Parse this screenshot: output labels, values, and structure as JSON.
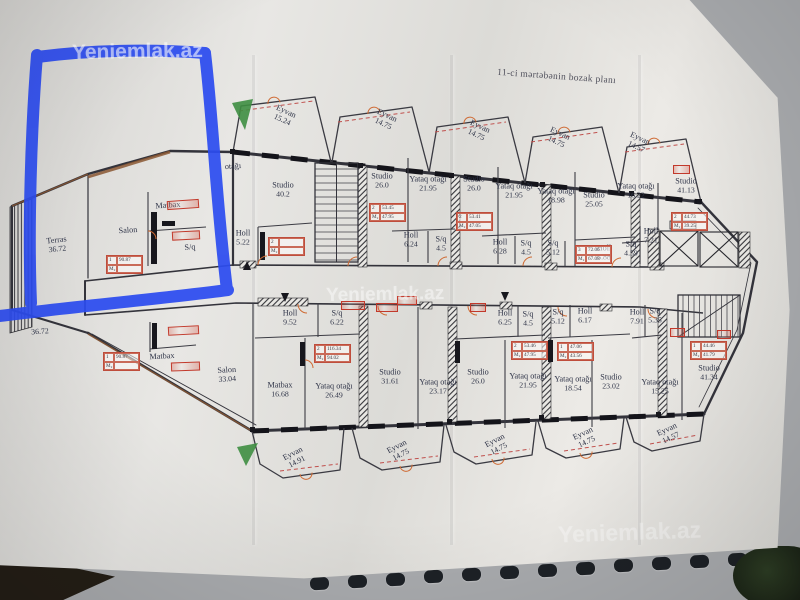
{
  "photo": {
    "title": "11-ci mərtəbənin bozak planı",
    "watermark_text": "Yeniemlak.az"
  },
  "annotation": {
    "marker_color": "#2c4cf0"
  },
  "watermarks": [
    {
      "x": 72,
      "y": 40,
      "size": 21,
      "rot": -1,
      "opacity": 0.6
    },
    {
      "x": 326,
      "y": 284,
      "size": 19,
      "rot": -1,
      "opacity": 0.48
    },
    {
      "x": 558,
      "y": 519,
      "size": 23,
      "rot": -2,
      "opacity": 0.4
    }
  ],
  "plan": {
    "rooms": [
      {
        "name": "Terras",
        "area": "36.72",
        "x": 57,
        "y": 245,
        "rot": -6
      },
      {
        "name": "Salon",
        "area": "",
        "x": 128,
        "y": 231,
        "rot": -4
      },
      {
        "name": "Matbax",
        "area": "",
        "x": 168,
        "y": 206,
        "rot": -4
      },
      {
        "name": "S/q",
        "area": "",
        "x": 190,
        "y": 248,
        "rot": -4
      },
      {
        "name": "otağı",
        "area": "",
        "x": 233,
        "y": 167,
        "rot": -4
      },
      {
        "name": "Holl",
        "area": "5.22",
        "x": 243,
        "y": 238,
        "rot": 0
      },
      {
        "name": "Eyvan",
        "area": "15.24",
        "x": 284,
        "y": 116,
        "rot": 25
      },
      {
        "name": "Studio",
        "area": "40.2",
        "x": 283,
        "y": 190,
        "rot": 0
      },
      {
        "name": "Eyvan",
        "area": "14.75",
        "x": 385,
        "y": 120,
        "rot": 25
      },
      {
        "name": "Studio",
        "area": "26.0",
        "x": 382,
        "y": 181,
        "rot": 0
      },
      {
        "name": "Yataq otağı",
        "area": "21.95",
        "x": 428,
        "y": 184,
        "rot": 0
      },
      {
        "name": "Holl",
        "area": "6.24",
        "x": 411,
        "y": 240,
        "rot": 0
      },
      {
        "name": "S/q",
        "area": "4.5",
        "x": 441,
        "y": 244,
        "rot": 0
      },
      {
        "name": "Eyvan",
        "area": "14.75",
        "x": 478,
        "y": 131,
        "rot": 25
      },
      {
        "name": "Studio",
        "area": "26.0",
        "x": 474,
        "y": 184,
        "rot": 0
      },
      {
        "name": "Yataq otağı",
        "area": "21.95",
        "x": 514,
        "y": 191,
        "rot": 0
      },
      {
        "name": "Holl",
        "area": "6.28",
        "x": 500,
        "y": 247,
        "rot": 0
      },
      {
        "name": "S/q",
        "area": "4.5",
        "x": 526,
        "y": 248,
        "rot": 0
      },
      {
        "name": "Eyvan",
        "area": "14.75",
        "x": 558,
        "y": 138,
        "rot": 25
      },
      {
        "name": "Yataq otağı",
        "area": "18.98",
        "x": 556,
        "y": 196,
        "rot": 0
      },
      {
        "name": "Studio",
        "area": "25.05",
        "x": 594,
        "y": 200,
        "rot": 0
      },
      {
        "name": "S/q",
        "area": "5.12",
        "x": 553,
        "y": 248,
        "rot": 0
      },
      {
        "name": "Holl",
        "area": "6.88",
        "x": 604,
        "y": 253,
        "rot": 0
      },
      {
        "name": "Eyvan",
        "area": "14.57",
        "x": 638,
        "y": 143,
        "rot": 25
      },
      {
        "name": "Yataq otağı",
        "area": "16.22",
        "x": 636,
        "y": 191,
        "rot": 0
      },
      {
        "name": "Studio",
        "area": "41.13",
        "x": 686,
        "y": 186,
        "rot": 0
      },
      {
        "name": "S/q",
        "area": "4.59",
        "x": 631,
        "y": 249,
        "rot": 0
      },
      {
        "name": "Holl",
        "area": "7.21",
        "x": 651,
        "y": 236,
        "rot": 0
      },
      {
        "name": "",
        "area": "36.72",
        "x": 40,
        "y": 332,
        "rot": -4
      },
      {
        "name": "Salon",
        "area": "33.04",
        "x": 227,
        "y": 375,
        "rot": -3
      },
      {
        "name": "Matbax",
        "area": "",
        "x": 162,
        "y": 357,
        "rot": -3
      },
      {
        "name": "Holl",
        "area": "9.52",
        "x": 290,
        "y": 318,
        "rot": 0
      },
      {
        "name": "S/q",
        "area": "6.22",
        "x": 337,
        "y": 318,
        "rot": 0
      },
      {
        "name": "Matbax",
        "area": "16.68",
        "x": 280,
        "y": 390,
        "rot": 0
      },
      {
        "name": "Yataq otağı",
        "area": "26.49",
        "x": 334,
        "y": 391,
        "rot": 0
      },
      {
        "name": "Studio",
        "area": "31.61",
        "x": 390,
        "y": 377,
        "rot": 0
      },
      {
        "name": "Eyvan",
        "area": "14.91",
        "x": 295,
        "y": 458,
        "rot": -27
      },
      {
        "name": "Yataq otağı",
        "area": "23.17",
        "x": 438,
        "y": 387,
        "rot": 0
      },
      {
        "name": "Studio",
        "area": "26.0",
        "x": 478,
        "y": 377,
        "rot": 0
      },
      {
        "name": "Holl",
        "area": "6.25",
        "x": 505,
        "y": 318,
        "rot": 0
      },
      {
        "name": "S/q",
        "area": "4.5",
        "x": 528,
        "y": 319,
        "rot": 0
      },
      {
        "name": "Yataq otağı",
        "area": "21.95",
        "x": 528,
        "y": 381,
        "rot": 0
      },
      {
        "name": "Eyvan",
        "area": "14.75",
        "x": 399,
        "y": 451,
        "rot": -27
      },
      {
        "name": "S/q",
        "area": "5.12",
        "x": 558,
        "y": 317,
        "rot": 0
      },
      {
        "name": "Holl",
        "area": "6.17",
        "x": 585,
        "y": 316,
        "rot": 0
      },
      {
        "name": "Yataq otağı",
        "area": "18.54",
        "x": 573,
        "y": 384,
        "rot": 0
      },
      {
        "name": "Studio",
        "area": "23.02",
        "x": 611,
        "y": 382,
        "rot": 0
      },
      {
        "name": "Eyvan",
        "area": "14.75",
        "x": 497,
        "y": 445,
        "rot": -27
      },
      {
        "name": "Holl",
        "area": "7.91",
        "x": 637,
        "y": 317,
        "rot": 0
      },
      {
        "name": "S/q",
        "area": "5.35",
        "x": 655,
        "y": 316,
        "rot": 0
      },
      {
        "name": "Yataq otağı",
        "area": "15.25",
        "x": 660,
        "y": 387,
        "rot": 0
      },
      {
        "name": "Studio",
        "area": "41.34",
        "x": 709,
        "y": 373,
        "rot": 0
      },
      {
        "name": "Eyvan",
        "area": "14.75",
        "x": 585,
        "y": 438,
        "rot": -25
      },
      {
        "name": "Eyvan",
        "area": "14.57",
        "x": 669,
        "y": 434,
        "rot": -25
      }
    ],
    "tables": [
      {
        "x": 106,
        "y": 255,
        "rows": [
          [
            "1",
            "90.87"
          ],
          [
            "M₂",
            ""
          ]
        ]
      },
      {
        "x": 268,
        "y": 237,
        "rows": [
          [
            "2",
            ""
          ],
          [
            "M₂",
            ""
          ]
        ]
      },
      {
        "x": 369,
        "y": 203,
        "rows": [
          [
            "2",
            "53.45"
          ],
          [
            "M₂",
            "47.95"
          ]
        ]
      },
      {
        "x": 456,
        "y": 212,
        "rows": [
          [
            "2",
            "53.41"
          ],
          [
            "M₂",
            "47.05"
          ]
        ]
      },
      {
        "x": 575,
        "y": 245,
        "rows": [
          [
            "3",
            "72.06"
          ],
          [
            "M₂",
            "67.08"
          ]
        ]
      },
      {
        "x": 671,
        "y": 212,
        "rows": [
          [
            "2",
            "44.73"
          ],
          [
            "M₂",
            "39.25"
          ]
        ]
      },
      {
        "x": 103,
        "y": 352,
        "rows": [
          [
            "1",
            "90.87"
          ],
          [
            "M₂",
            ""
          ]
        ]
      },
      {
        "x": 314,
        "y": 344,
        "rows": [
          [
            "2",
            "116.34"
          ],
          [
            "M₂",
            "94.02"
          ]
        ]
      },
      {
        "x": 511,
        "y": 341,
        "rows": [
          [
            "2",
            "53.46"
          ],
          [
            "M₂",
            "47.95"
          ]
        ]
      },
      {
        "x": 557,
        "y": 342,
        "rows": [
          [
            "1",
            "47.06"
          ],
          [
            "M₂",
            "43.56"
          ]
        ]
      },
      {
        "x": 690,
        "y": 341,
        "rows": [
          [
            "1",
            "44.46"
          ],
          [
            "M₂",
            "41.79"
          ]
        ]
      }
    ],
    "dim_boxes": [
      {
        "x": 167,
        "y": 200,
        "w": 30,
        "rot": -4
      },
      {
        "x": 172,
        "y": 231,
        "w": 26,
        "rot": -3
      },
      {
        "x": 168,
        "y": 326,
        "w": 29,
        "rot": -3
      },
      {
        "x": 171,
        "y": 362,
        "w": 27,
        "rot": -2
      },
      {
        "x": 341,
        "y": 301,
        "w": 22,
        "rot": 0
      },
      {
        "x": 376,
        "y": 303,
        "w": 20,
        "rot": 0
      },
      {
        "x": 470,
        "y": 303,
        "w": 14,
        "rot": 0
      },
      {
        "x": 670,
        "y": 328,
        "w": 13,
        "rot": 0
      },
      {
        "x": 717,
        "y": 330,
        "w": 12,
        "rot": 0
      },
      {
        "x": 673,
        "y": 165,
        "w": 15,
        "rot": 0
      },
      {
        "x": 397,
        "y": 296,
        "w": 18,
        "rot": 0
      }
    ]
  }
}
